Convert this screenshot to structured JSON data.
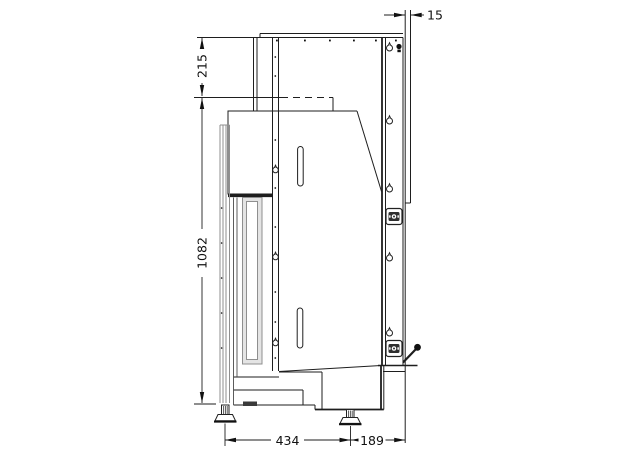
{
  "drawing": {
    "dimensions": {
      "wall_offset": "15",
      "top_section_height": "215",
      "body_height": "1082",
      "depth_front": "434",
      "depth_rear": "189"
    },
    "colors": {
      "line": "#1e1e1e",
      "light_line": "#8f8f8f",
      "dark_fill": "#2e2e2e",
      "glass_fill": "#e4e4e4",
      "background": "#ffffff"
    }
  }
}
